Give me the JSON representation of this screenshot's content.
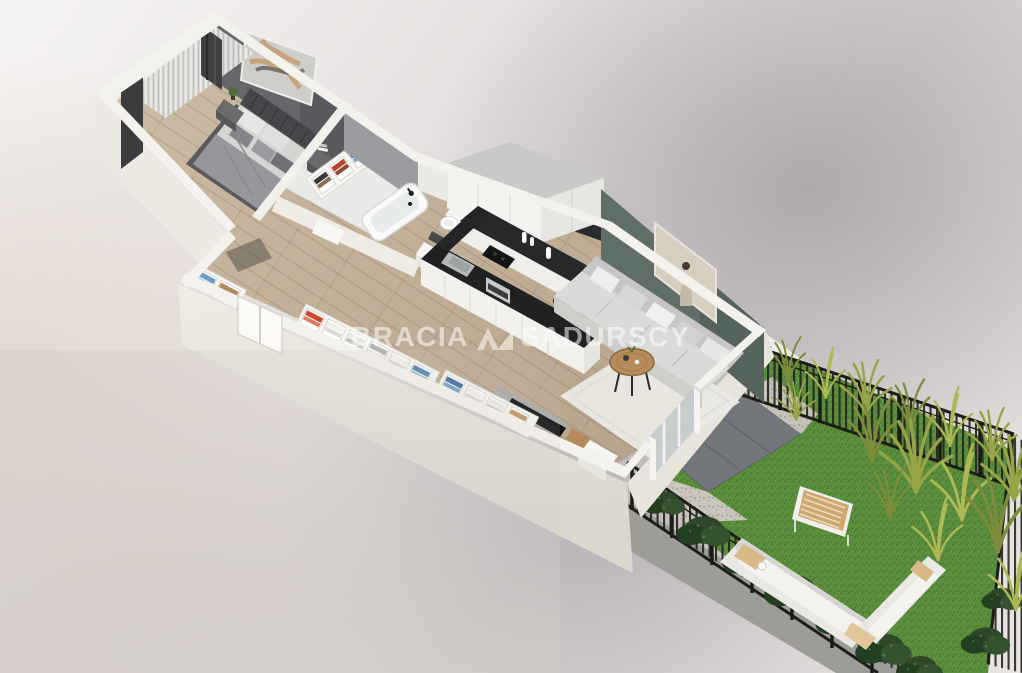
{
  "scene": {
    "description": "3D isometric floor plan render of a one-bedroom apartment (bedroom, bathroom, hallway with wardrobes, open kitchen, living room) with a fenced garden terrace"
  },
  "watermark": {
    "part1": "BRACIA",
    "part2": "SADURSCY",
    "logo_icon": "brand-triangles-logo",
    "text_color": "#ffffff",
    "text_opacity": "0.55"
  },
  "palette": {
    "background_light": "#f6f4f3",
    "background_shadow": "#aaa4a8",
    "background_warm": "#e2d5cb",
    "wall_white": "#f4f2ec",
    "wall_shade": "#e3dfd6",
    "floor_wood": "#c4b29c",
    "bathroom_floor": "#eaeae8",
    "bedroom_accent_wall": "#66666b",
    "living_accent_wall": "#5f6f68",
    "kitchen_counter": "#1f2123",
    "sofa_gray": "#d9d8d6",
    "rug_white": "#ebe9e4",
    "lawn_green": "#5b8e3d",
    "paving_gray": "#73767a",
    "gravel_beige": "#c9c5bb",
    "fence_black": "#24241f",
    "tall_grass_olive": "#97a447",
    "shrub_green": "#2e4829",
    "wood_furniture": "#b78c5c",
    "artwork_beige": "#d7cec2"
  }
}
